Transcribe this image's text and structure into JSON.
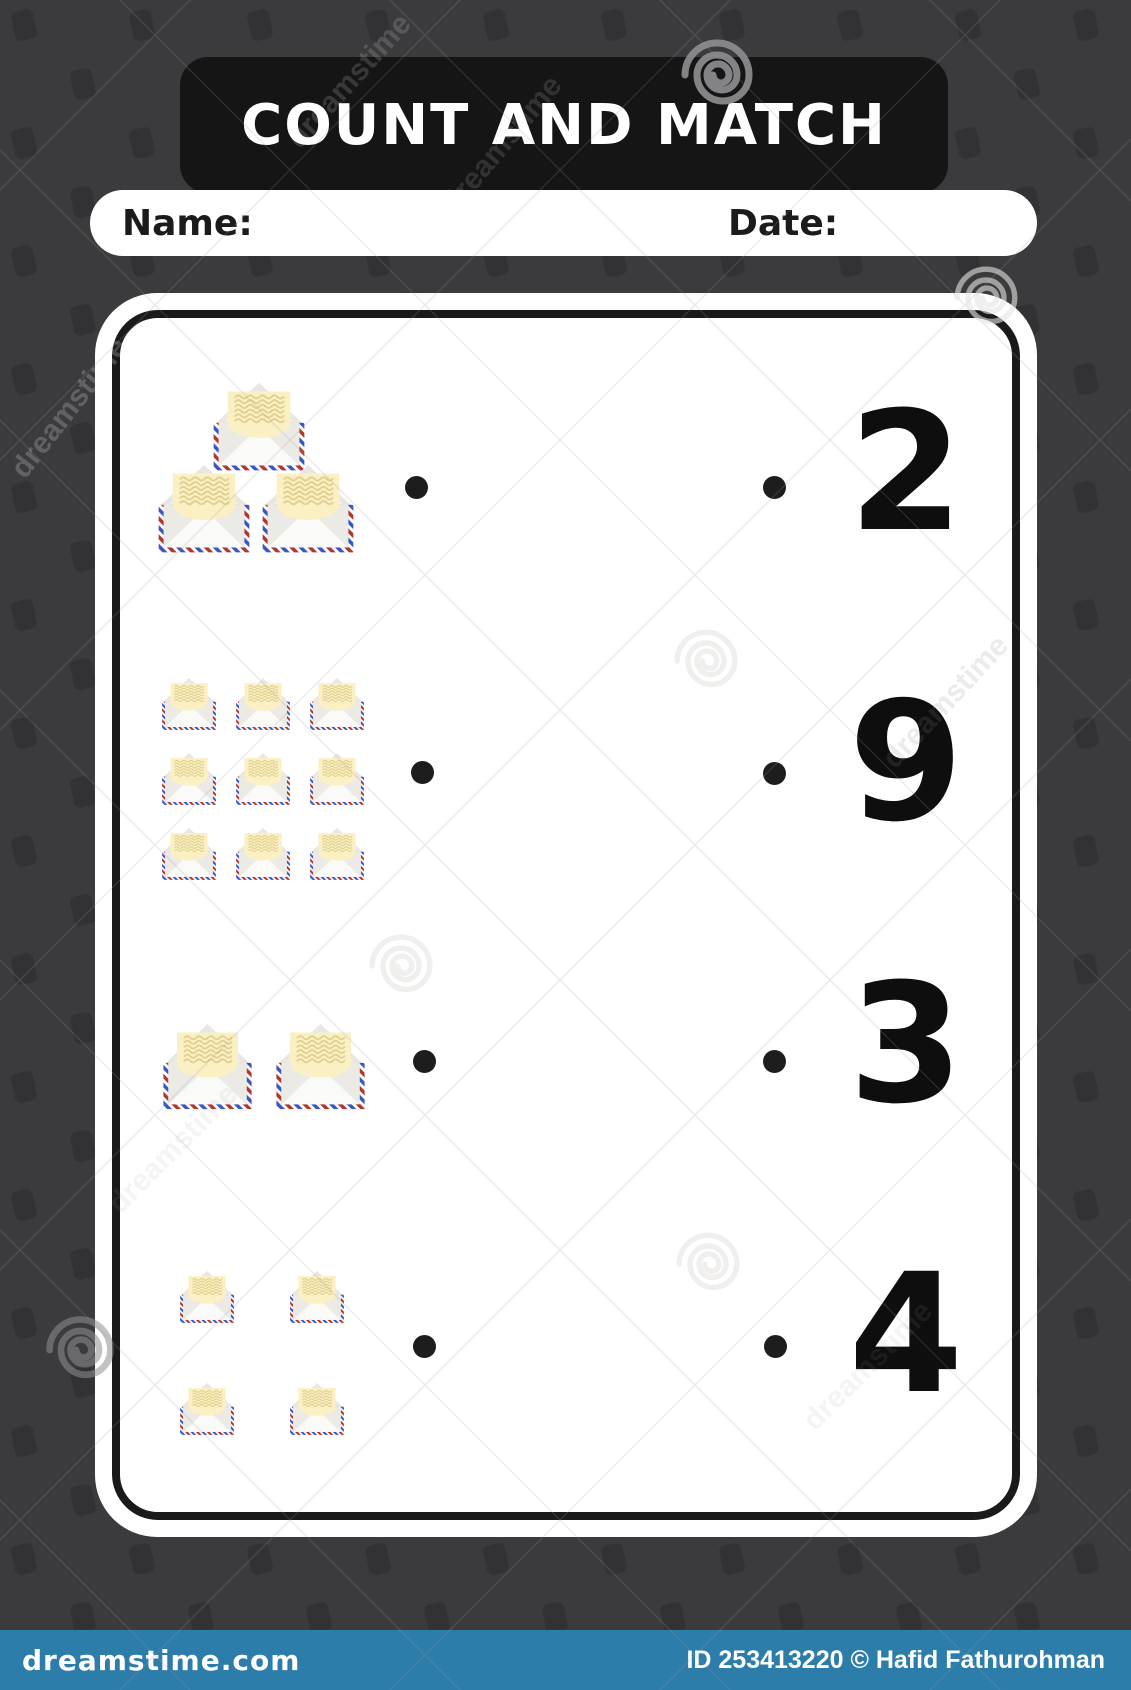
{
  "title": "COUNT AND MATCH",
  "form": {
    "name_label": "Name:",
    "date_label": "Date:"
  },
  "worksheet": {
    "instruction_icon": "open-airmail-envelope-letter-icon",
    "rows": [
      {
        "envelope_count": 3,
        "number": "2"
      },
      {
        "envelope_count": 9,
        "number": "9"
      },
      {
        "envelope_count": 2,
        "number": "3"
      },
      {
        "envelope_count": 4,
        "number": "4"
      }
    ]
  },
  "footer": {
    "site": "dreamstime.com",
    "credit": "ID 253413220 © Hafid Fathurohman"
  },
  "watermark": {
    "brand": "dreamstime"
  },
  "colors": {
    "background": "#3b3b3d",
    "title_box": "#151515",
    "footer_bar": "#2d7dab",
    "envelope_red": "#b23530",
    "envelope_blue": "#3a55c4",
    "letter_yellow": "#faf0c3",
    "number_ink": "#0e0e0e"
  }
}
